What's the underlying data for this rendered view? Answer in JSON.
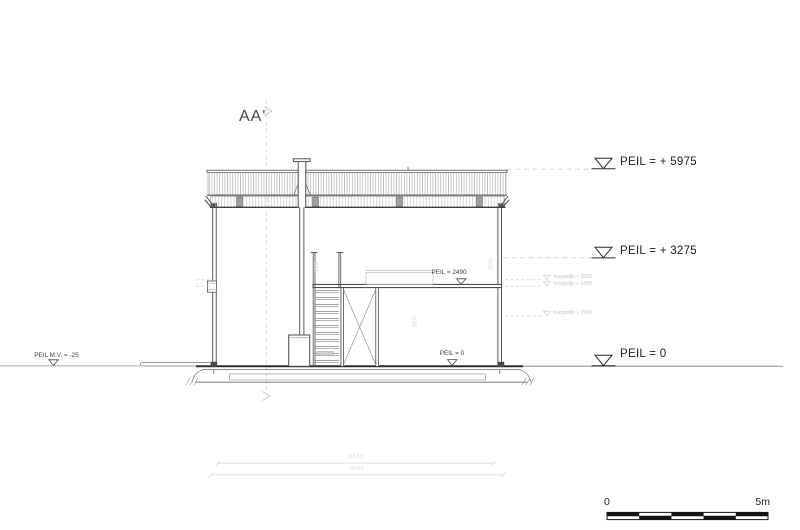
{
  "title": {
    "section_label": "AA'"
  },
  "markers": {
    "roof": "PEIL = + 5975",
    "upper": "PEIL = + 3275",
    "ground": "PEIL = 0",
    "ground_left": "PEIL M.V. = -25",
    "floor_interior": "PEIL = 2490",
    "ground_interior": "PEIL = 0",
    "icon": "open-triangle-down"
  },
  "height_lines": [
    {
      "label": "hoogtelijn + 2600"
    },
    {
      "label": "hoogtelijn + 2400"
    },
    {
      "label": "hoogtelijn + 1500"
    }
  ],
  "vertical_dims": [
    {
      "value": "1000"
    },
    {
      "value": "2400"
    },
    {
      "value": "2600"
    }
  ],
  "width_dims": {
    "inner": "8540",
    "outer": "9060"
  },
  "scale_bar": {
    "start": "0",
    "end": "5m"
  },
  "colors": {
    "line_dark": "#3f3f3f",
    "line_faint": "#c9c9c9",
    "dim_faint": "#dcdcdc",
    "scale_fill": "#151515",
    "background": "#ffffff"
  }
}
